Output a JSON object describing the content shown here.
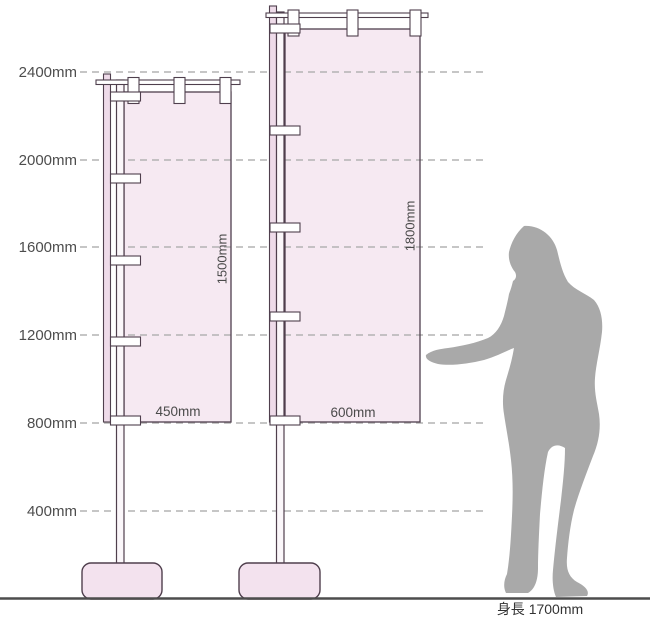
{
  "diagram": {
    "axis_labels": [
      "2400mm",
      "2000mm",
      "1600mm",
      "1200mm",
      "800mm",
      "400mm"
    ],
    "axis_values_mm": [
      2400,
      2000,
      1600,
      1200,
      800,
      400
    ],
    "left_banner": {
      "width_label": "450mm",
      "height_label": "1500mm",
      "width_mm": 450,
      "height_mm": 1500,
      "top_mm": 2300,
      "bottom_mm": 800
    },
    "right_banner": {
      "width_label": "600mm",
      "height_label": "1800mm",
      "width_mm": 600,
      "height_mm": 1800,
      "top_mm": 2600,
      "bottom_mm": 800
    },
    "person": {
      "label": "身長 1700mm",
      "height_mm": 1700
    },
    "colors": {
      "banner_fill": "#f6e9f2",
      "sleeve_fill": "#eedbe9",
      "pole_fill": "#fbf7fa",
      "structure_outline": "#4f3f4d",
      "gridline": "#b3b3b3",
      "silhouette": "#a9a9a9",
      "ground_line": "#4d4d4d",
      "base_fill": "#f3e2ee",
      "label_text": "#4d4d4d"
    }
  }
}
